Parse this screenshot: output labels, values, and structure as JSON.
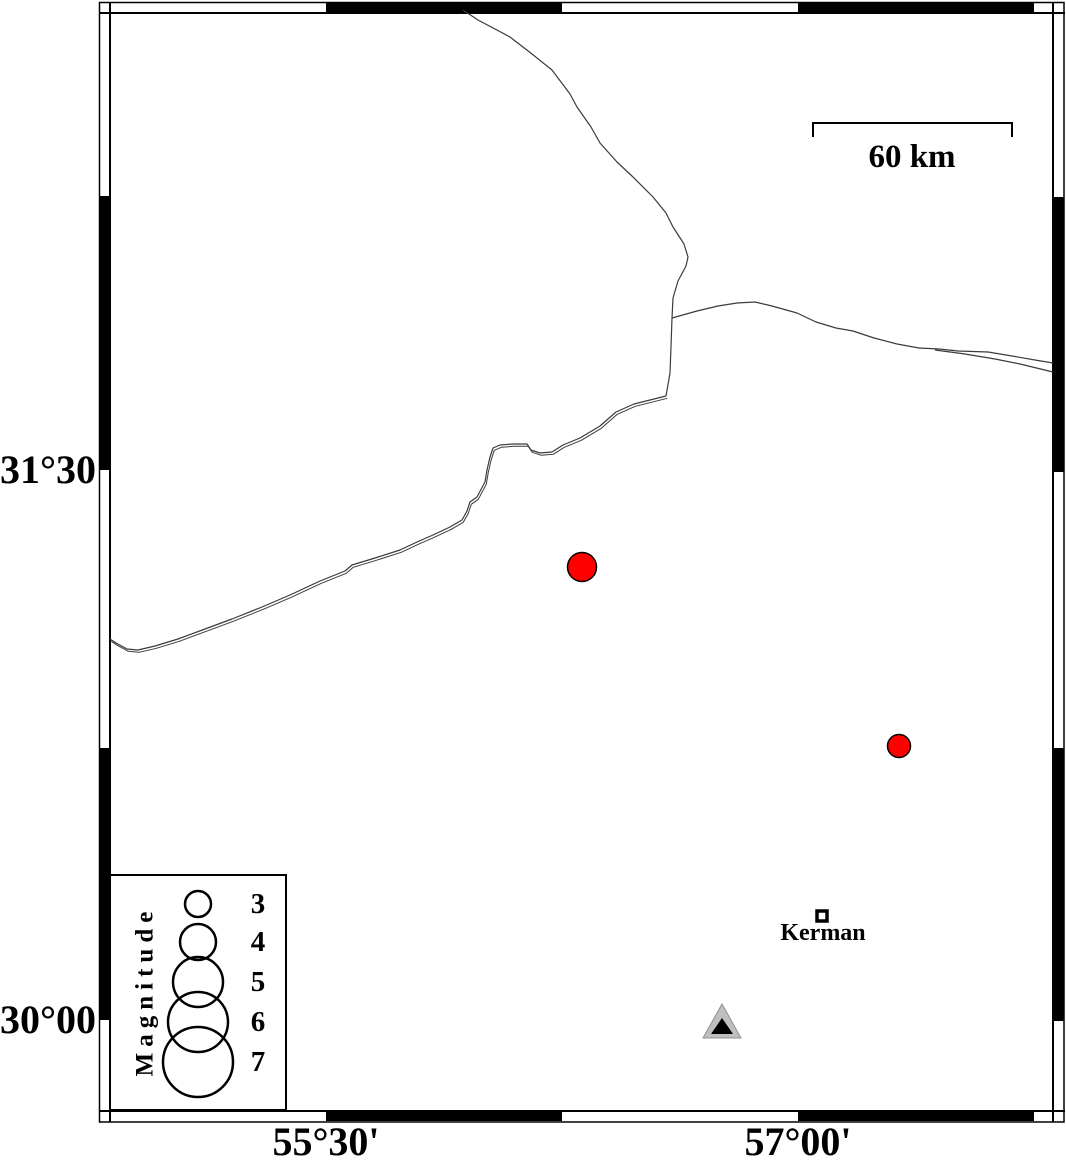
{
  "figure": {
    "type": "seismicity-map",
    "extent_approx": {
      "lon_left": 54.81,
      "lon_right": 57.81,
      "lat_top": 32.74,
      "lat_bottom": 29.75
    }
  },
  "axes": {
    "left_labels": [
      {
        "text": "31°30'",
        "y": 470
      },
      {
        "text": "30°00'",
        "y": 1020
      }
    ],
    "bottom_labels": [
      {
        "text": "55°30'",
        "x": 326
      },
      {
        "text": "57°00'",
        "x": 798
      }
    ]
  },
  "frame": {
    "outer": [
      99.5,
      2.5,
      964.5,
      1119.5
    ],
    "inner": {
      "left": 110,
      "top": 13,
      "right": 1053,
      "bottom": 1111
    },
    "band_black": {
      "top": [
        [
          326,
          562
        ],
        [
          798,
          1034
        ]
      ],
      "bottom": [
        [
          326,
          562
        ],
        [
          798,
          1034
        ]
      ],
      "left": [
        [
          196,
          470
        ],
        [
          748,
          1020
        ]
      ],
      "right": [
        [
          197,
          472
        ],
        [
          748,
          1021
        ]
      ]
    }
  },
  "scale_bar": {
    "label": "60 km",
    "x1": 813,
    "x2": 1012,
    "y": 123,
    "tick_drop": 14
  },
  "map_content": {
    "boundaries": [
      {
        "name": "boundary-north",
        "double": false,
        "points": [
          [
            463,
            10
          ],
          [
            478,
            20
          ],
          [
            510,
            37
          ],
          [
            532,
            54
          ],
          [
            552,
            70
          ],
          [
            558,
            78
          ],
          [
            570,
            94
          ],
          [
            577,
            107
          ],
          [
            591,
            127
          ],
          [
            600,
            143
          ],
          [
            617,
            162
          ],
          [
            633,
            177
          ],
          [
            653,
            197
          ],
          [
            666,
            213
          ],
          [
            673,
            227
          ],
          [
            684,
            244
          ],
          [
            688,
            257
          ],
          [
            686,
            266
          ],
          [
            678,
            281
          ],
          [
            673,
            298
          ],
          [
            672,
            318
          ],
          [
            671,
            347
          ],
          [
            670,
            373
          ],
          [
            666,
            396
          ]
        ]
      },
      {
        "name": "boundary-southwest",
        "double": true,
        "points": [
          [
            666,
            396
          ],
          [
            650,
            400
          ],
          [
            634,
            404
          ],
          [
            616,
            412
          ],
          [
            600,
            426
          ],
          [
            580,
            438
          ],
          [
            563,
            445
          ],
          [
            552,
            452
          ],
          [
            540,
            453
          ],
          [
            531,
            450
          ],
          [
            527,
            444
          ],
          [
            513,
            444
          ],
          [
            500,
            445
          ],
          [
            493,
            448
          ],
          [
            490,
            457
          ],
          [
            487,
            470
          ],
          [
            485,
            482
          ],
          [
            477,
            497
          ],
          [
            470,
            502
          ],
          [
            467,
            511
          ],
          [
            462,
            520
          ],
          [
            450,
            527
          ],
          [
            433,
            535
          ],
          [
            417,
            542
          ],
          [
            400,
            550
          ],
          [
            375,
            558
          ],
          [
            352,
            565
          ],
          [
            345,
            571
          ],
          [
            320,
            581
          ],
          [
            290,
            595
          ],
          [
            262,
            607
          ],
          [
            232,
            619
          ],
          [
            205,
            629
          ],
          [
            178,
            639
          ],
          [
            155,
            646
          ],
          [
            138,
            650
          ],
          [
            127,
            649
          ],
          [
            116,
            643
          ],
          [
            110,
            639
          ]
        ]
      },
      {
        "name": "boundary-east",
        "double": false,
        "points": [
          [
            672,
            318
          ],
          [
            697,
            311
          ],
          [
            718,
            306
          ],
          [
            737,
            303
          ],
          [
            755,
            302
          ],
          [
            772,
            306
          ],
          [
            797,
            313
          ],
          [
            816,
            322
          ],
          [
            836,
            328
          ],
          [
            853,
            331
          ],
          [
            874,
            338
          ],
          [
            897,
            344
          ],
          [
            919,
            348
          ],
          [
            939,
            349
          ],
          [
            958,
            351
          ],
          [
            988,
            352
          ],
          [
            1012,
            356
          ],
          [
            1035,
            360
          ],
          [
            1053,
            363
          ]
        ]
      },
      {
        "name": "boundary-east-branch",
        "double": false,
        "points": [
          [
            935,
            350
          ],
          [
            965,
            354
          ],
          [
            995,
            359
          ],
          [
            1020,
            364
          ],
          [
            1053,
            372
          ]
        ]
      }
    ],
    "earthquakes": [
      {
        "x": 582,
        "y": 567,
        "radius_px": 14.5,
        "approx_lon": 56.31,
        "approx_lat": 31.24
      },
      {
        "x": 899,
        "y": 746,
        "radius_px": 11.5,
        "approx_lon": 57.32,
        "approx_lat": 30.75
      }
    ],
    "city": {
      "name": "Kerman",
      "x": 822,
      "y": 916,
      "approx_lon": 57.08,
      "approx_lat": 30.28
    },
    "station": {
      "x": 722,
      "approx_lon": 56.76,
      "approx_lat": 29.99,
      "outer_points": "722,1004 703,1038 741,1038",
      "inner_points": "722,1018 711,1034 733,1034"
    }
  },
  "legend": {
    "title": "Magnitude",
    "box": [
      110,
      875,
      176,
      235
    ],
    "circle_cx": 198,
    "entries": [
      {
        "label": "3",
        "cy": 904,
        "radius_px": 13
      },
      {
        "label": "4",
        "cy": 942,
        "radius_px": 18
      },
      {
        "label": "5",
        "cy": 982,
        "radius_px": 25
      },
      {
        "label": "6",
        "cy": 1022,
        "radius_px": 30
      },
      {
        "label": "7",
        "cy": 1062,
        "radius_px": 35
      }
    ]
  },
  "colors": {
    "earthquake_fill": "#ff0000",
    "marker_stroke": "#000000",
    "boundary_line": "#3b3b3b",
    "station_fill": "#bfbfbf",
    "station_edge": "#8f8f8f",
    "station_inner": "#000000",
    "frame": "#000000"
  }
}
